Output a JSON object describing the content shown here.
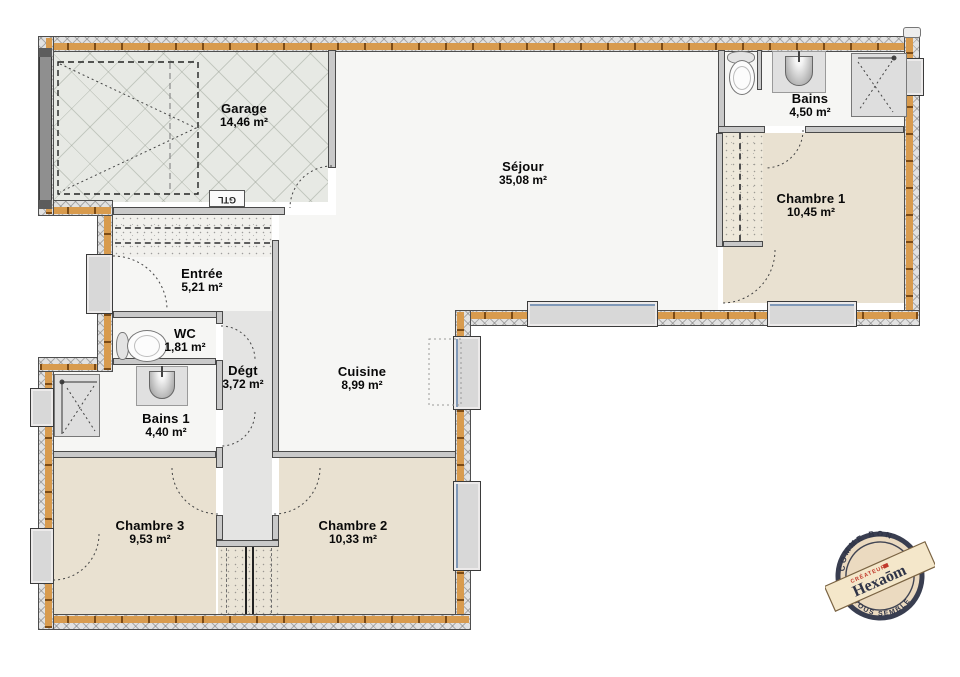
{
  "plan": {
    "rooms": [
      {
        "name": "Garage",
        "area": "14,46 m²"
      },
      {
        "name": "Séjour",
        "area": "35,08 m²"
      },
      {
        "name": "Bains",
        "area": "4,50 m²"
      },
      {
        "name": "Chambre 1",
        "area": "10,45 m²"
      },
      {
        "name": "Entrée",
        "area": "5,21 m²"
      },
      {
        "name": "WC",
        "area": "1,81 m²"
      },
      {
        "name": "Dégt",
        "area": "3,72 m²"
      },
      {
        "name": "Cuisine",
        "area": "8,99 m²"
      },
      {
        "name": "Bains 1",
        "area": "4,40 m²"
      },
      {
        "name": "Chambre 3",
        "area": "9,53 m²"
      },
      {
        "name": "Chambre 2",
        "area": "10,33 m²"
      }
    ],
    "annotations": {
      "gtl": "GTL"
    },
    "stamp": {
      "brand": "Hexaōm",
      "tagline": "CRÉATEUR",
      "ring_top": "COMME BON",
      "ring_bottom": "VOUS SEMBLE"
    },
    "colors": {
      "wood": "#d89b4e",
      "wall_hatch": "#e2e2e2",
      "floor_bedroom": "#e9e1d1",
      "floor_main": "#f6f6f4",
      "floor_corridor": "#e4e4e3",
      "window": "#d8d8d8",
      "stamp_navy": "#2f3447",
      "stamp_red": "#c0392b",
      "label_text": "#080808"
    }
  }
}
